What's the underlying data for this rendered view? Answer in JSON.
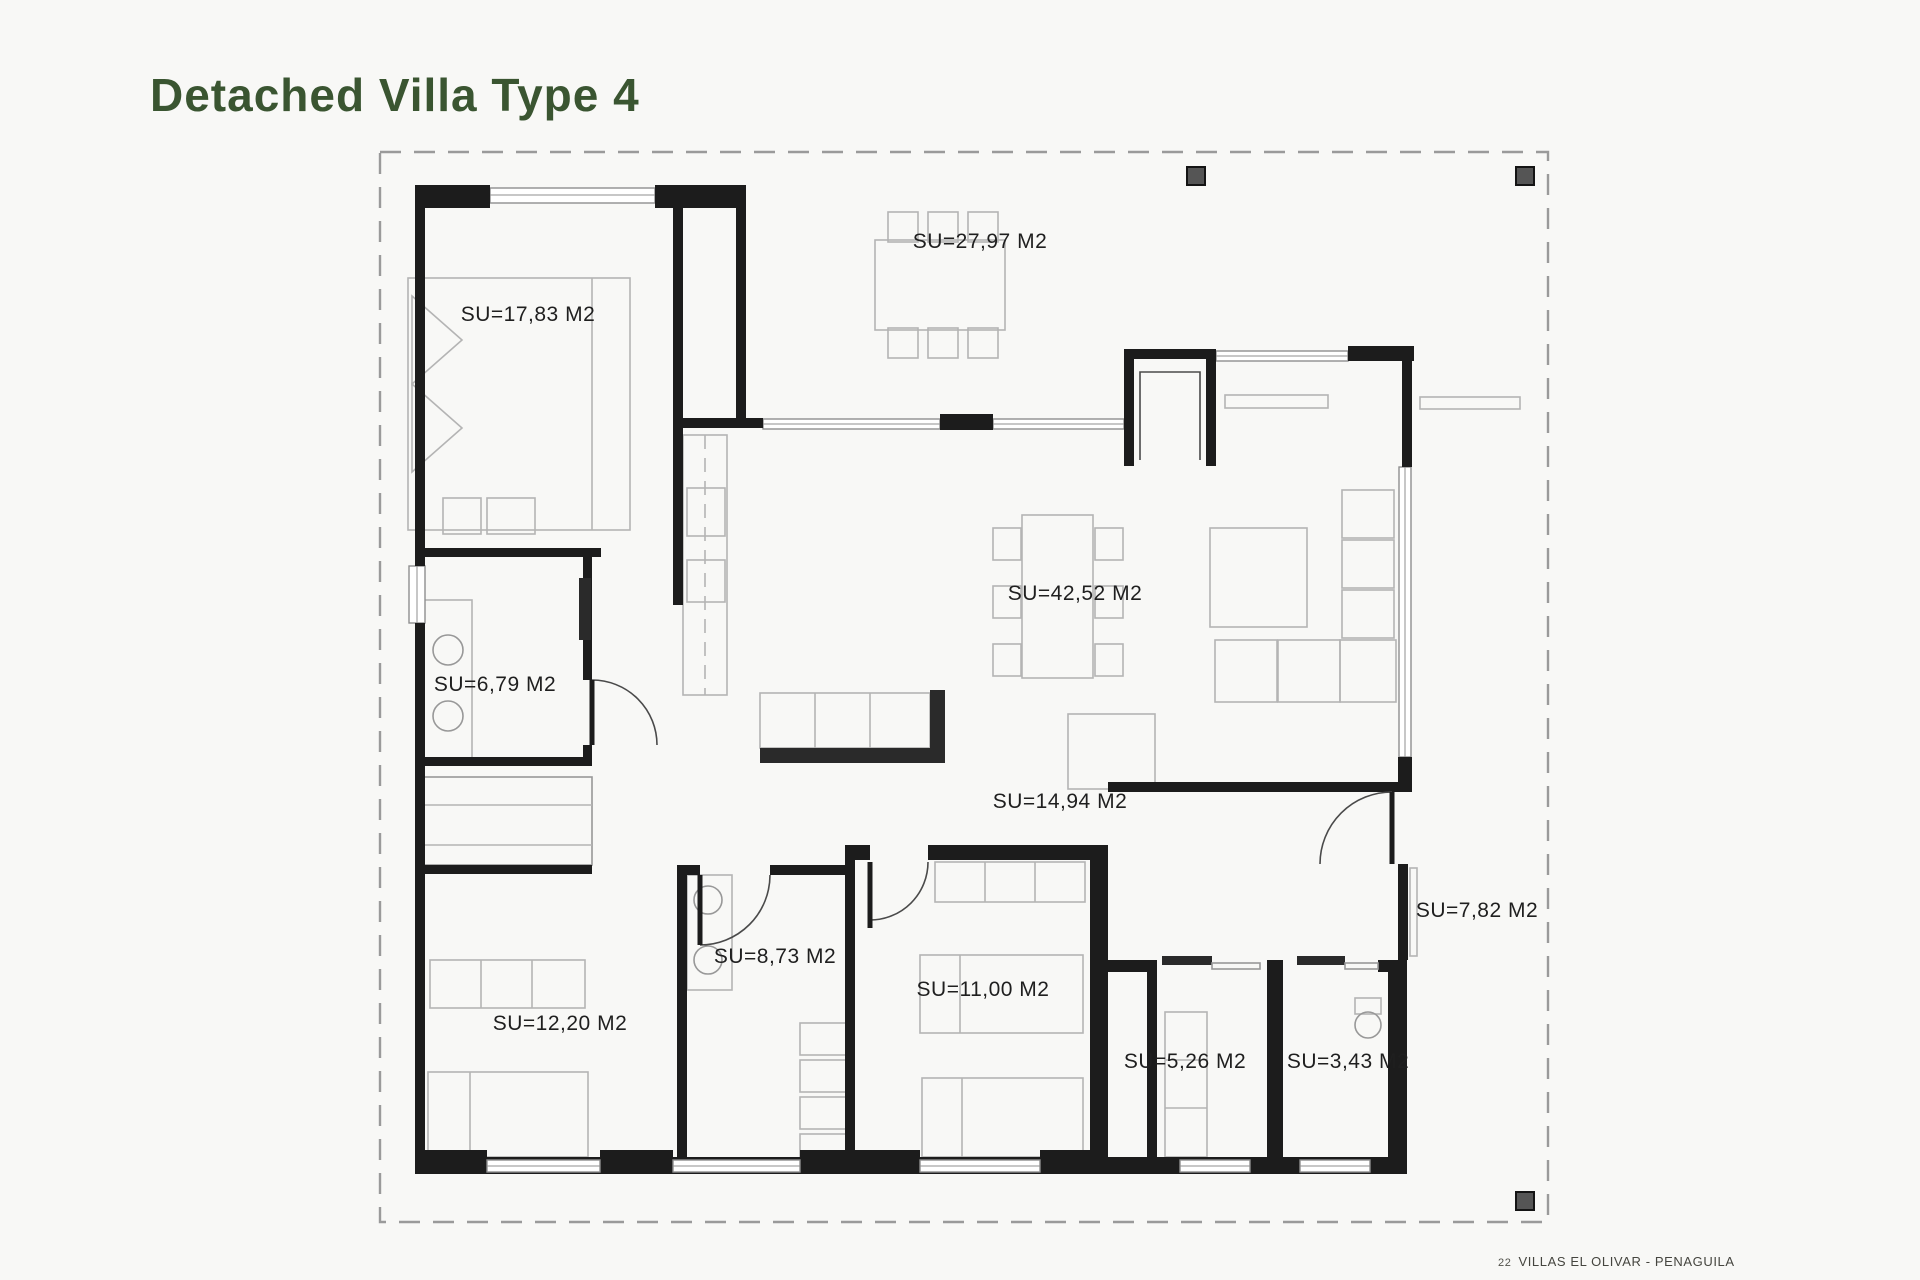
{
  "page": {
    "title": "Detached Villa Type 4",
    "footer": {
      "page_number": "22",
      "project": "VILLAS EL OLIVAR - PENAGUILA"
    },
    "colors": {
      "title_green": "#3a5531",
      "wall_black": "#1c1c1c",
      "furniture_gray": "#b4b4b4",
      "dashed_border_gray": "#9a9a9a",
      "pillar_gray": "#555555",
      "label_black": "#1f1f1f",
      "page_background": "#f8f8f6"
    }
  },
  "floor_plan": {
    "area_unit": "M2",
    "rooms": [
      {
        "id": "bedroom-main",
        "area_label": "SU=17,83 M2"
      },
      {
        "id": "terrace",
        "area_label": "SU=27,97 M2"
      },
      {
        "id": "living-dining",
        "area_label": "SU=42,52 M2"
      },
      {
        "id": "bathroom-1",
        "area_label": "SU=6,79 M2"
      },
      {
        "id": "hallway",
        "area_label": "SU=14,94 M2"
      },
      {
        "id": "bathroom-2",
        "area_label": "SU=8,73 M2"
      },
      {
        "id": "bedroom-2",
        "area_label": "SU=12,20 M2"
      },
      {
        "id": "bedroom-3",
        "area_label": "SU=11,00 M2"
      },
      {
        "id": "storage",
        "area_label": "SU=5,26 M2"
      },
      {
        "id": "wc",
        "area_label": "SU=3,43 M2"
      },
      {
        "id": "side-porch",
        "area_label": "SU=7,82 M2"
      }
    ]
  }
}
